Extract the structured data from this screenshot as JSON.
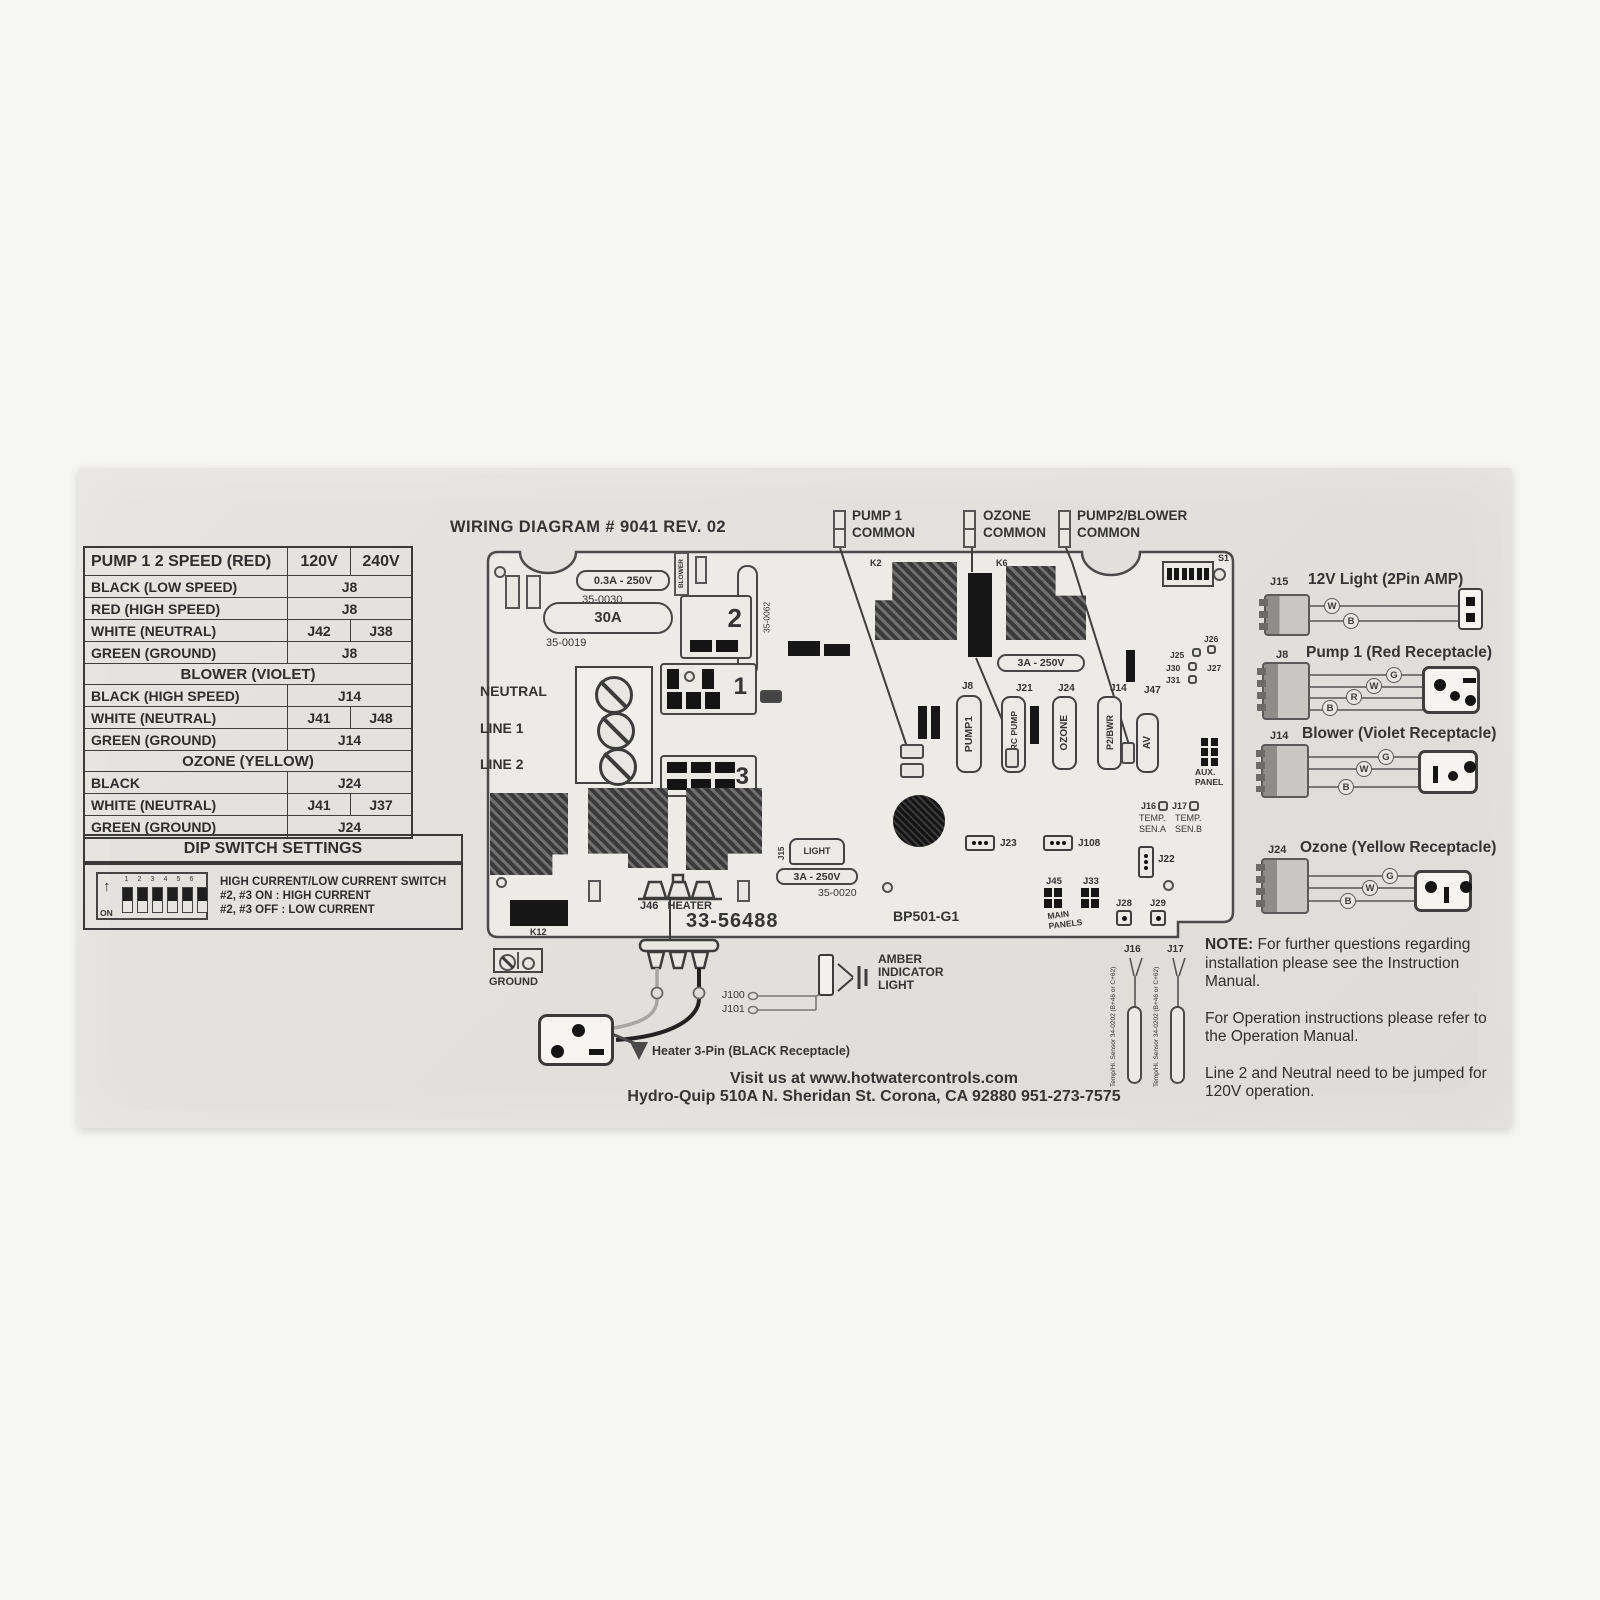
{
  "title": "WIRING DIAGRAM # 9041 REV. 02",
  "table": {
    "header": [
      "PUMP 1 2 SPEED (RED)",
      "120V",
      "240V"
    ],
    "rows": [
      {
        "label": "BLACK (LOW SPEED)",
        "v": "J8"
      },
      {
        "label": "RED (HIGH SPEED)",
        "v": "J8"
      },
      {
        "label": "WHITE (NEUTRAL)",
        "v120": "J42",
        "v240": "J38"
      },
      {
        "label": "GREEN (GROUND)",
        "v": "J8"
      },
      {
        "section": "BLOWER (VIOLET)"
      },
      {
        "label": "BLACK (HIGH SPEED)",
        "v": "J14"
      },
      {
        "label": "WHITE (NEUTRAL)",
        "v120": "J41",
        "v240": "J48"
      },
      {
        "label": "GREEN (GROUND)",
        "v": "J14"
      },
      {
        "section": "OZONE (YELLOW)"
      },
      {
        "label": "BLACK",
        "v": "J24"
      },
      {
        "label": "WHITE (NEUTRAL)",
        "v120": "J41",
        "v240": "J37"
      },
      {
        "label": "GREEN (GROUND)",
        "v": "J24"
      }
    ]
  },
  "dip": {
    "title": "DIP SWITCH SETTINGS",
    "on": "ON",
    "numbers": [
      "1",
      "2",
      "3",
      "4",
      "5",
      "6"
    ],
    "line1": "HIGH CURRENT/LOW CURRENT SWITCH",
    "line2": "#2, #3 ON : HIGH CURRENT",
    "line3": "#2, #3 OFF : LOW CURRENT"
  },
  "board": {
    "common1a": "PUMP 1",
    "common1b": "COMMON",
    "common2a": "OZONE",
    "common2b": "COMMON",
    "common3a": "PUMP2/BLOWER",
    "common3b": "COMMON",
    "fuse_03a": "0.3A - 250V",
    "pn_35_0030": "35-0030",
    "fuse_30a": "30A",
    "pn_35_0019": "35-0019",
    "blower_vert": "BLOWER",
    "fuse_10a": "10A - 250V",
    "pn_35_0062": "35-0062",
    "relay1": "1",
    "relay2": "2",
    "relay3": "3",
    "neutral": "NEUTRAL",
    "line1": "LINE 1",
    "line2": "LINE 2",
    "k2": "K2",
    "k6": "K6",
    "s1": "S1",
    "k12": "K12",
    "fuse_3a": "3A - 250V",
    "pn_35_0020": "35-0020",
    "j8": "J8",
    "j21": "J21",
    "j24": "J24",
    "j14": "J14",
    "j47": "J47",
    "pump1": "PUMP1",
    "circ_pump": "CIRC PUMP",
    "ozone": "OZONE",
    "p2bwr": "P2/BWR",
    "av": "AV",
    "j25": "J25",
    "j26": "J26",
    "j27": "J27",
    "j30": "J30",
    "j31": "J31",
    "aux1": "AUX.",
    "aux2": "PANEL",
    "j16": "J16",
    "j17": "J17",
    "temp": "TEMP.",
    "sena": "SEN.A",
    "senb": "SEN.B",
    "j23": "J23",
    "j108": "J108",
    "j22": "J22",
    "j45": "J45",
    "j33": "J33",
    "main1": "MAIN",
    "main2": "PANELS",
    "j28": "J28",
    "j29": "J29",
    "board_id": "BP501-G1",
    "part_number": "33-56488",
    "j15": "J15",
    "light": "LIGHT",
    "j46_heater": "J46   HEATER"
  },
  "bottom": {
    "ground": "GROUND",
    "j100": "J100",
    "j101": "J101",
    "amber1": "AMBER",
    "amber2": "INDICATOR",
    "amber3": "LIGHT",
    "heater_label": "Heater 3-Pin (BLACK Receptacle)",
    "j16": "J16",
    "j17": "J17",
    "sensor_text": "Temp/Hi. Sensor 34-0202 (B+46 or C+62)"
  },
  "right": [
    {
      "j": "J15",
      "title": "12V Light (2Pin AMP)",
      "wires": [
        "W",
        "B"
      ]
    },
    {
      "j": "J8",
      "title": "Pump 1 (Red Receptacle)",
      "wires": [
        "G",
        "W",
        "R",
        "B"
      ]
    },
    {
      "j": "J14",
      "title": "Blower (Violet Receptacle)",
      "wires": [
        "G",
        "W",
        "B"
      ]
    },
    {
      "j": "J24",
      "title": "Ozone (Yellow Receptacle)",
      "wires": [
        "G",
        "W",
        "B"
      ]
    }
  ],
  "notes": {
    "label": "NOTE:",
    "p1": " For further questions regarding installation please see the Instruction Manual.",
    "p2": "For Operation instructions please refer to the Operation Manual.",
    "p3": "Line 2 and Neutral need to be jumped for 120V operation."
  },
  "footer": {
    "line1": "Visit us at www.hotwatercontrols.com",
    "line2": "Hydro-Quip 510A N. Sheridan St. Corona, CA 92880 951-273-7575"
  }
}
